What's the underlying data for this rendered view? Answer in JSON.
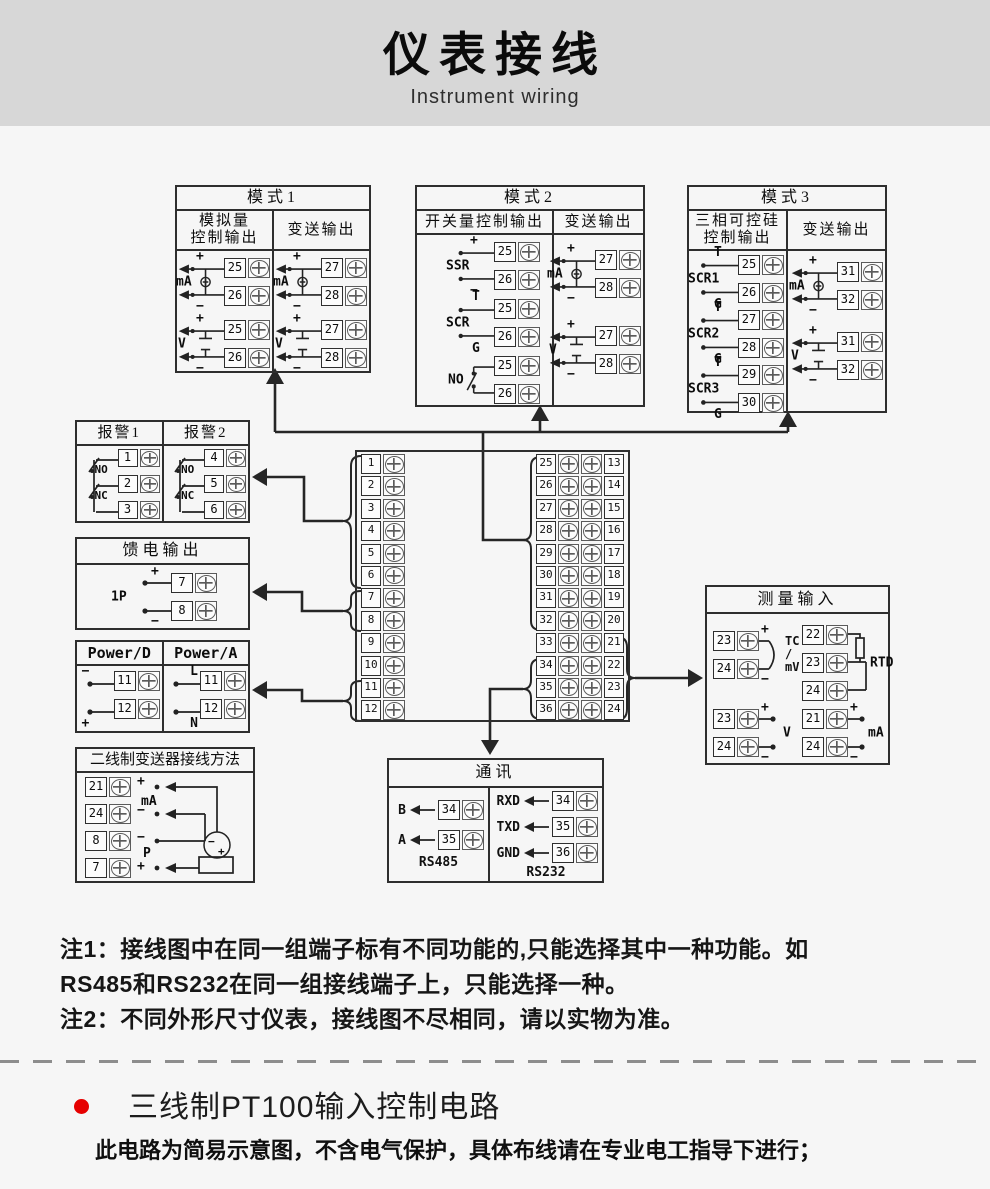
{
  "colors": {
    "header_band": "#d7d7d7",
    "line": "#2e2e2e",
    "bullet_red": "#e60000"
  },
  "header": {
    "title": "仪表接线",
    "subtitle": "Instrument wiring"
  },
  "mode1": {
    "title": "模式1",
    "col1_line1": "模拟量",
    "col1_line2": "控制输出",
    "col2": "变送输出",
    "ma_l": {
      "label": "mA",
      "plus": "+",
      "minus": "−",
      "t1": "25",
      "t2": "26"
    },
    "v_l": {
      "label": "V",
      "plus": "+",
      "minus": "−",
      "t1": "25",
      "t2": "26"
    },
    "ma_r": {
      "label": "mA",
      "plus": "+",
      "minus": "−",
      "t1": "27",
      "t2": "28"
    },
    "v_r": {
      "label": "V",
      "plus": "+",
      "minus": "−",
      "t1": "27",
      "t2": "28"
    }
  },
  "mode2": {
    "title": "模式2",
    "col1": "开关量控制输出",
    "col2": "变送输出",
    "ssr": {
      "label": "SSR",
      "plus": "+",
      "minus": "−",
      "t1": "25",
      "t2": "26"
    },
    "scr": {
      "label": "SCR",
      "top": "T",
      "bottom": "G",
      "t1": "25",
      "t2": "26"
    },
    "no": {
      "label": "NO",
      "t1": "25",
      "t2": "26"
    },
    "ma": {
      "label": "mA",
      "plus": "+",
      "minus": "−",
      "t1": "27",
      "t2": "28"
    },
    "v": {
      "label": "V",
      "plus": "+",
      "minus": "−",
      "t1": "27",
      "t2": "28"
    }
  },
  "mode3": {
    "title": "模式3",
    "col1_line1": "三相可控硅",
    "col1_line2": "控制输出",
    "col2": "变送输出",
    "scr": [
      {
        "label": "SCR1",
        "top": "T",
        "bottom": "G",
        "t1": "25",
        "t2": "26"
      },
      {
        "label": "SCR2",
        "top": "T",
        "bottom": "G",
        "t1": "27",
        "t2": "28"
      },
      {
        "label": "SCR3",
        "top": "T",
        "bottom": "G",
        "t1": "29",
        "t2": "30"
      }
    ],
    "ma": {
      "label": "mA",
      "plus": "+",
      "minus": "−",
      "t1": "31",
      "t2": "32"
    },
    "v": {
      "label": "V",
      "plus": "+",
      "minus": "−",
      "t1": "31",
      "t2": "32"
    }
  },
  "alarm": {
    "title1": "报警1",
    "title2": "报警2",
    "no": "NO",
    "nc": "NC",
    "col1": [
      "1",
      "2",
      "3"
    ],
    "col2": [
      "4",
      "5",
      "6"
    ]
  },
  "feed": {
    "title": "馈电输出",
    "label": "1P",
    "plus": "+",
    "minus": "−",
    "t1": "7",
    "t2": "8"
  },
  "power": {
    "title_d": "Power/D",
    "title_a": "Power/A",
    "d_minus": "−",
    "d_plus": "+",
    "d_t1": "11",
    "d_t2": "12",
    "a_l": "L",
    "a_n": "N",
    "a_t1": "11",
    "a_t2": "12"
  },
  "twowire": {
    "title": "二线制变送器接线方法",
    "terms": [
      "21",
      "24",
      "8",
      "7"
    ],
    "lab_plus_top": "+",
    "lab_ma": "mA",
    "lab_minus1": "−",
    "lab_minus2": "−",
    "lab_p": "P",
    "lab_plus_bot": "+",
    "tx_minus": "−",
    "tx_plus": "+"
  },
  "central": {
    "left": [
      "1",
      "2",
      "3",
      "4",
      "5",
      "6",
      "7",
      "8",
      "9",
      "10",
      "11",
      "12"
    ],
    "right": [
      {
        "a": "25",
        "b": "13"
      },
      {
        "a": "26",
        "b": "14"
      },
      {
        "a": "27",
        "b": "15"
      },
      {
        "a": "28",
        "b": "16"
      },
      {
        "a": "29",
        "b": "17"
      },
      {
        "a": "30",
        "b": "18"
      },
      {
        "a": "31",
        "b": "19"
      },
      {
        "a": "32",
        "b": "20"
      },
      {
        "a": "33",
        "b": "21"
      },
      {
        "a": "34",
        "b": "22"
      },
      {
        "a": "35",
        "b": "23"
      },
      {
        "a": "36",
        "b": "24"
      }
    ]
  },
  "comm": {
    "title": "通讯",
    "rs485": "RS485",
    "rs232": "RS232",
    "left": [
      {
        "sig": "B",
        "num": "34"
      },
      {
        "sig": "A",
        "num": "35"
      }
    ],
    "right": [
      {
        "sig": "RXD",
        "num": "34"
      },
      {
        "sig": "TXD",
        "num": "35"
      },
      {
        "sig": "GND",
        "num": "36"
      }
    ]
  },
  "measure": {
    "title": "测量输入",
    "tc": {
      "t1": "23",
      "t2": "24",
      "plus": "+",
      "minus": "−",
      "label": "TC\n/\nmV"
    },
    "rtd": {
      "t1": "22",
      "t2": "23",
      "t3": "24",
      "label": "RTD"
    },
    "v": {
      "t1": "23",
      "t2": "24",
      "plus": "+",
      "minus": "−",
      "label": "V"
    },
    "ma": {
      "t1": "21",
      "t2": "24",
      "plus": "+",
      "minus": "−",
      "label": "mA"
    }
  },
  "notes": {
    "line1": "注1：接线图中在同一组端子标有不同功能的,只能选择其中一种功能。如",
    "line2": "RS485和RS232在同一组接线端子上，只能选择一种。",
    "line3": "注2：不同外形尺寸仪表，接线图不尽相同，请以实物为准。"
  },
  "bottom": {
    "heading": "三线制PT100输入控制电路",
    "subheading": "此电路为简易示意图，不含电气保护，具体布线请在专业电工指导下进行；"
  }
}
